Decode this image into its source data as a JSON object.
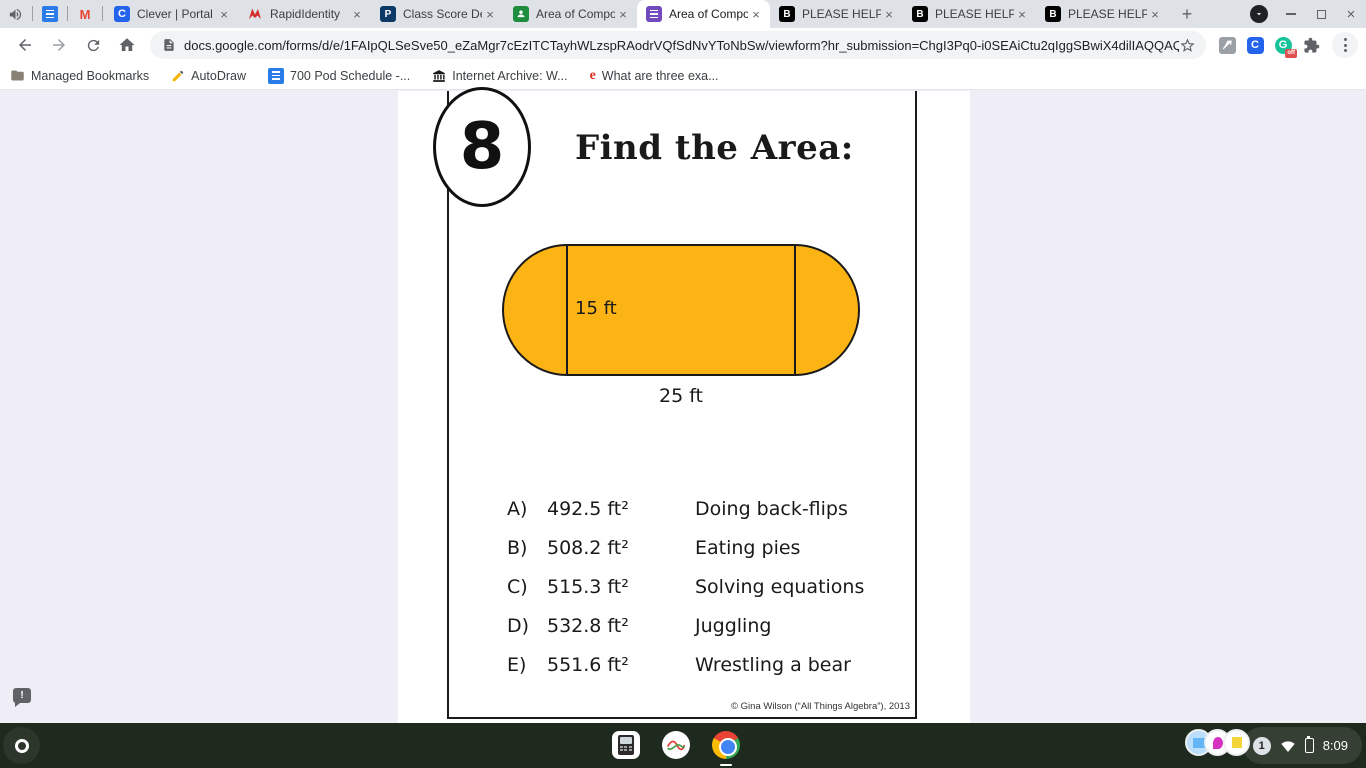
{
  "browser": {
    "pinned_tabs": [
      {
        "icon": "speaker-icon"
      },
      {
        "icon": "docs-icon"
      },
      {
        "icon": "gmail-icon",
        "glyph": "M"
      }
    ],
    "tabs": [
      {
        "title": "Clever | Portal",
        "icon": "clever",
        "glyph": "C"
      },
      {
        "title": "RapidIdentity",
        "icon": "rapididentity"
      },
      {
        "title": "Class Score De",
        "icon": "powerschool",
        "glyph": "P"
      },
      {
        "title": "Area of Compo",
        "icon": "classroom"
      },
      {
        "title": "Area of Compo",
        "icon": "forms",
        "active": true
      },
      {
        "title": "PLEASE HELPF",
        "icon": "brainly",
        "glyph": "B"
      },
      {
        "title": "PLEASE HELPF",
        "icon": "brainly",
        "glyph": "B"
      },
      {
        "title": "PLEASE HELPF",
        "icon": "brainly",
        "glyph": "B"
      }
    ],
    "omnibox": {
      "url": "docs.google.com/forms/d/e/1FAIpQLSeSve50_eZaMgr7cEzITCTayhWLzspRAodrVQfSdNvYToNbSw/viewform?hr_submission=ChgI3Pq0-i0SEAiCtu2qIggSBwiX4dilIAQQAQ"
    },
    "extensions": {
      "clever_glyph": "C",
      "grammarly_glyph": "G",
      "grammarly_badge": "off"
    },
    "bookmarks": [
      {
        "label": "Managed Bookmarks",
        "icon": "folder-icon"
      },
      {
        "label": "AutoDraw",
        "icon": "pencil-icon"
      },
      {
        "label": "700 Pod Schedule -...",
        "icon": "docs-icon"
      },
      {
        "label": "Internet Archive: W...",
        "icon": "archive-icon"
      },
      {
        "label": "What are three exa...",
        "icon": "red-e-icon",
        "glyph": "e"
      }
    ]
  },
  "worksheet": {
    "question_number": "8",
    "title": "Find the Area:",
    "shape": {
      "type": "stadium (rectangle with two semicircular ends)",
      "fill_color": "#FCB415",
      "height_label": "15 ft",
      "width_label": "25 ft"
    },
    "choices": [
      {
        "letter": "A)",
        "value": "492.5 ft²",
        "activity": "Doing back-flips"
      },
      {
        "letter": "B)",
        "value": "508.2 ft²",
        "activity": "Eating pies"
      },
      {
        "letter": "C)",
        "value": "515.3 ft²",
        "activity": "Solving equations"
      },
      {
        "letter": "D)",
        "value": "532.8 ft²",
        "activity": "Juggling"
      },
      {
        "letter": "E)",
        "value": "551.6 ft²",
        "activity": "Wrestling a bear"
      }
    ],
    "copyright": "© Gina Wilson (“All Things Algebra”), 2013",
    "report_glyph": "!"
  },
  "shelf": {
    "notification_count": "1",
    "time": "8:09"
  }
}
